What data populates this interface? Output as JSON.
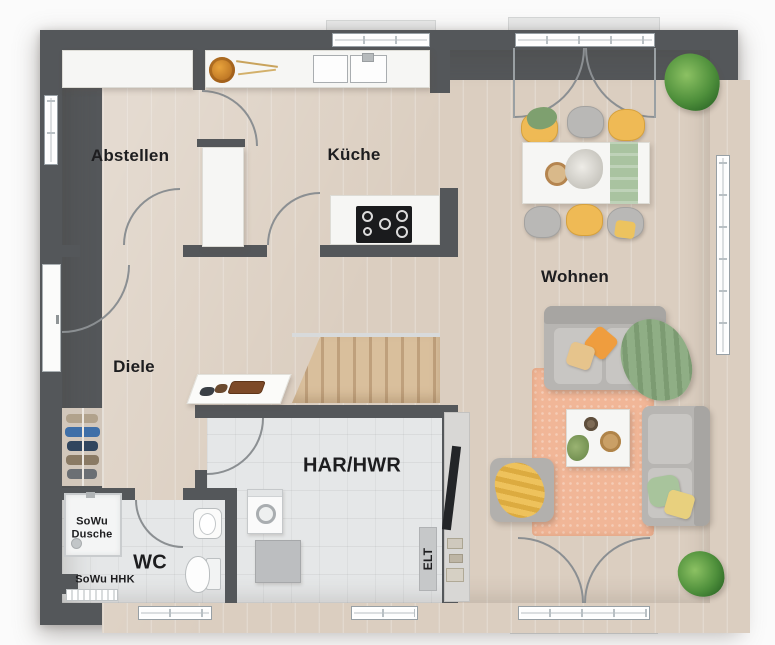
{
  "plan": {
    "title": "Erdgeschoss Grundriss",
    "rooms": {
      "abstellen": {
        "label": "Abstellen"
      },
      "kueche": {
        "label": "Küche"
      },
      "wohnen": {
        "label": "Wohnen"
      },
      "diele": {
        "label": "Diele"
      },
      "har_hwr": {
        "label": "HAR/HWR"
      },
      "wc": {
        "label": "WC"
      }
    },
    "annotations": {
      "shower": {
        "label": "SoWu Dusche"
      },
      "towel_radiator": {
        "label": "SoWu HHK"
      },
      "electrical": {
        "label": "ELT"
      }
    },
    "colors": {
      "wall": "#54575a",
      "floor_wood": "#dbcec0",
      "floor_tile": "#e5e7e8",
      "furniture_white": "#f6f6f4",
      "chair_yellow": "#efba55",
      "chair_gray": "#b9b8b6",
      "sofa_gray": "#b7b5b2",
      "rug_peach": "#f1b697",
      "runner_green": "#a9c3a0",
      "blanket_green": "#8fae85",
      "plant_green": "#4e8f3b",
      "stair_wood": "#d9bf9c",
      "stove_black": "#1a1b1d",
      "door_arc": "#8b8f92",
      "text": "#1d1d1f"
    }
  }
}
